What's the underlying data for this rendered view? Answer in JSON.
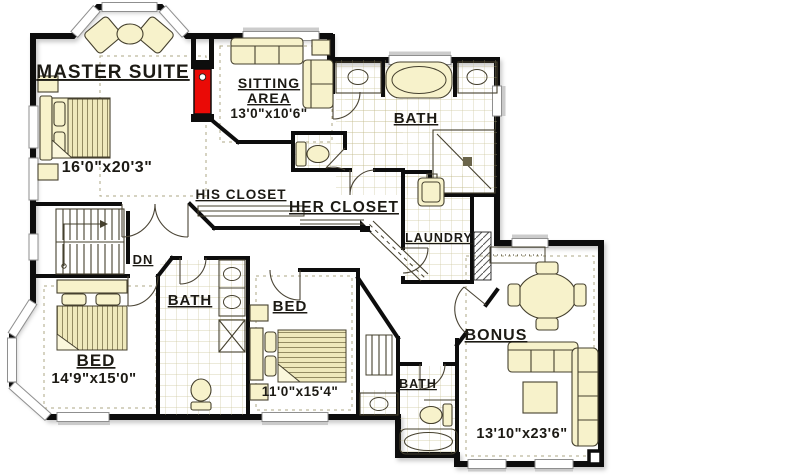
{
  "plan": {
    "type": "second-floor-plan",
    "colors": {
      "background": "#FFFFFF",
      "floor": "#F5EFC1",
      "wall": "#0D0D0D",
      "fireplace_red": "#EA0A06",
      "tile_line": "#BFB685",
      "window_gray": "#8F8F8F"
    },
    "rooms": {
      "master_suite": {
        "label": "MASTER SUITE",
        "dims": "16'0\"x20'3\""
      },
      "sitting_area": {
        "line1": "SITTING",
        "line2": "AREA",
        "dims": "13'0\"x10'6\""
      },
      "master_bath": {
        "label": "BATH"
      },
      "his_closet": {
        "label": "HIS CLOSET"
      },
      "her_closet": {
        "label": "HER CLOSET"
      },
      "laundry": {
        "label": "LAUNDRY"
      },
      "stairs": {
        "label": "DN"
      },
      "hall_bath": {
        "label": "BATH"
      },
      "bed_left": {
        "label": "BED",
        "dims": "14'9\"x15'0\""
      },
      "bed_middle": {
        "label": "BED",
        "dims": "11'0\"x15'4\""
      },
      "lower_bath": {
        "label": "BATH"
      },
      "bonus_room": {
        "label": "BONUS",
        "dims": "13'10\"x23'6\""
      }
    }
  }
}
